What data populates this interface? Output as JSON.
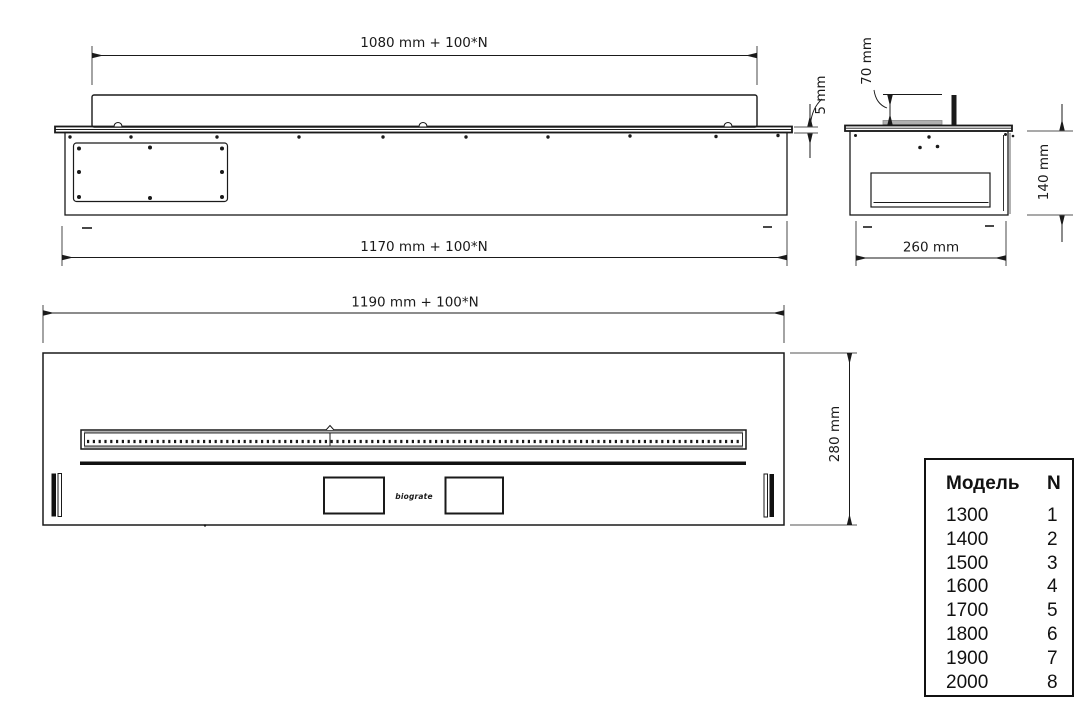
{
  "views": {
    "side": {
      "top_width_label": "1080 mm + 100*N",
      "bottom_width_label": "1170 mm + 100*N",
      "plate_thickness_label": "5 mm"
    },
    "end": {
      "burner_height_label": "70 mm",
      "body_height_label": "140 mm",
      "depth_label": "260 mm"
    },
    "plan": {
      "width_label": "1190 mm + 100*N",
      "depth_label": "280 mm",
      "logo": "biograte"
    }
  },
  "model_table": {
    "header": {
      "model": "Модель",
      "n": "N"
    },
    "rows": [
      {
        "model": "1300",
        "n": "1"
      },
      {
        "model": "1400",
        "n": "2"
      },
      {
        "model": "1500",
        "n": "3"
      },
      {
        "model": "1600",
        "n": "4"
      },
      {
        "model": "1700",
        "n": "5"
      },
      {
        "model": "1800",
        "n": "6"
      },
      {
        "model": "1900",
        "n": "7"
      },
      {
        "model": "2000",
        "n": "8"
      }
    ]
  },
  "colors": {
    "line": "#1a1a1a",
    "background": "#ffffff",
    "slot_gray": "#b0b0b0"
  }
}
